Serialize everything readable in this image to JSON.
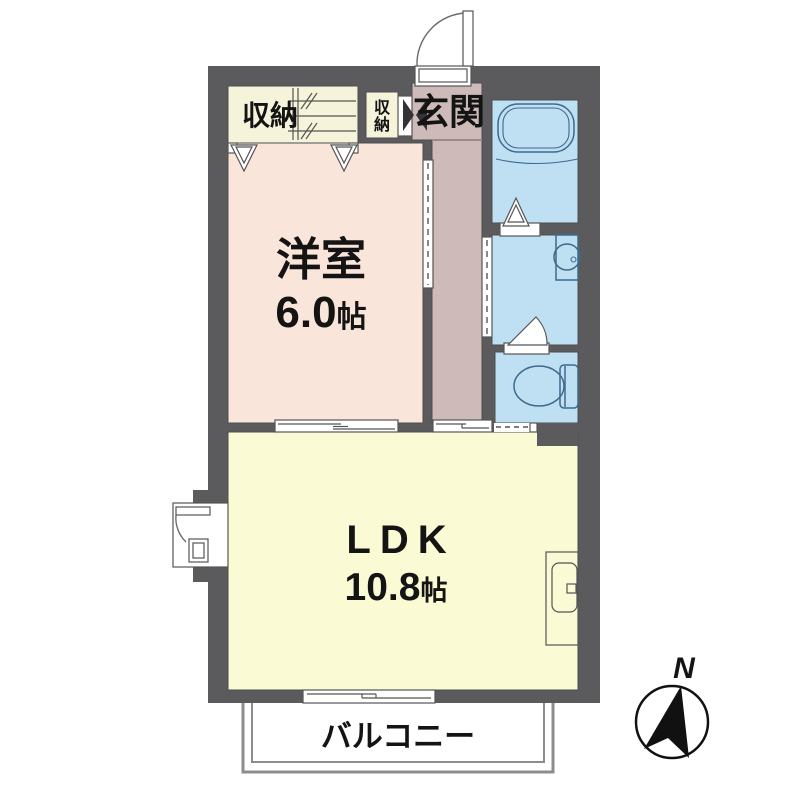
{
  "title": "apartment-floorplan",
  "colors": {
    "wall": "#5B5B5D",
    "closet": "#F6F3DB",
    "western_room": "#FAE5DA",
    "entrance_hall": "#CEBAB8",
    "wet_area": "#BFDFF3",
    "ldk": "#FAFAD4",
    "balcony_border": "#8D8D8D",
    "fixture_stroke": "#3D6B8B",
    "symbol_stroke": "#555555",
    "text": "#141414"
  },
  "rooms": {
    "closet_main": {
      "label": "収納"
    },
    "closet_small": {
      "chars": [
        "収",
        "納"
      ]
    },
    "entrance": {
      "label": "玄関"
    },
    "western": {
      "label": "洋室",
      "size": "6.0",
      "unit": "帖"
    },
    "ldk": {
      "label": "LDK",
      "size": "10.8",
      "unit": "帖"
    },
    "balcony": {
      "label": "バルコニー"
    }
  },
  "compass": {
    "label": "N"
  }
}
